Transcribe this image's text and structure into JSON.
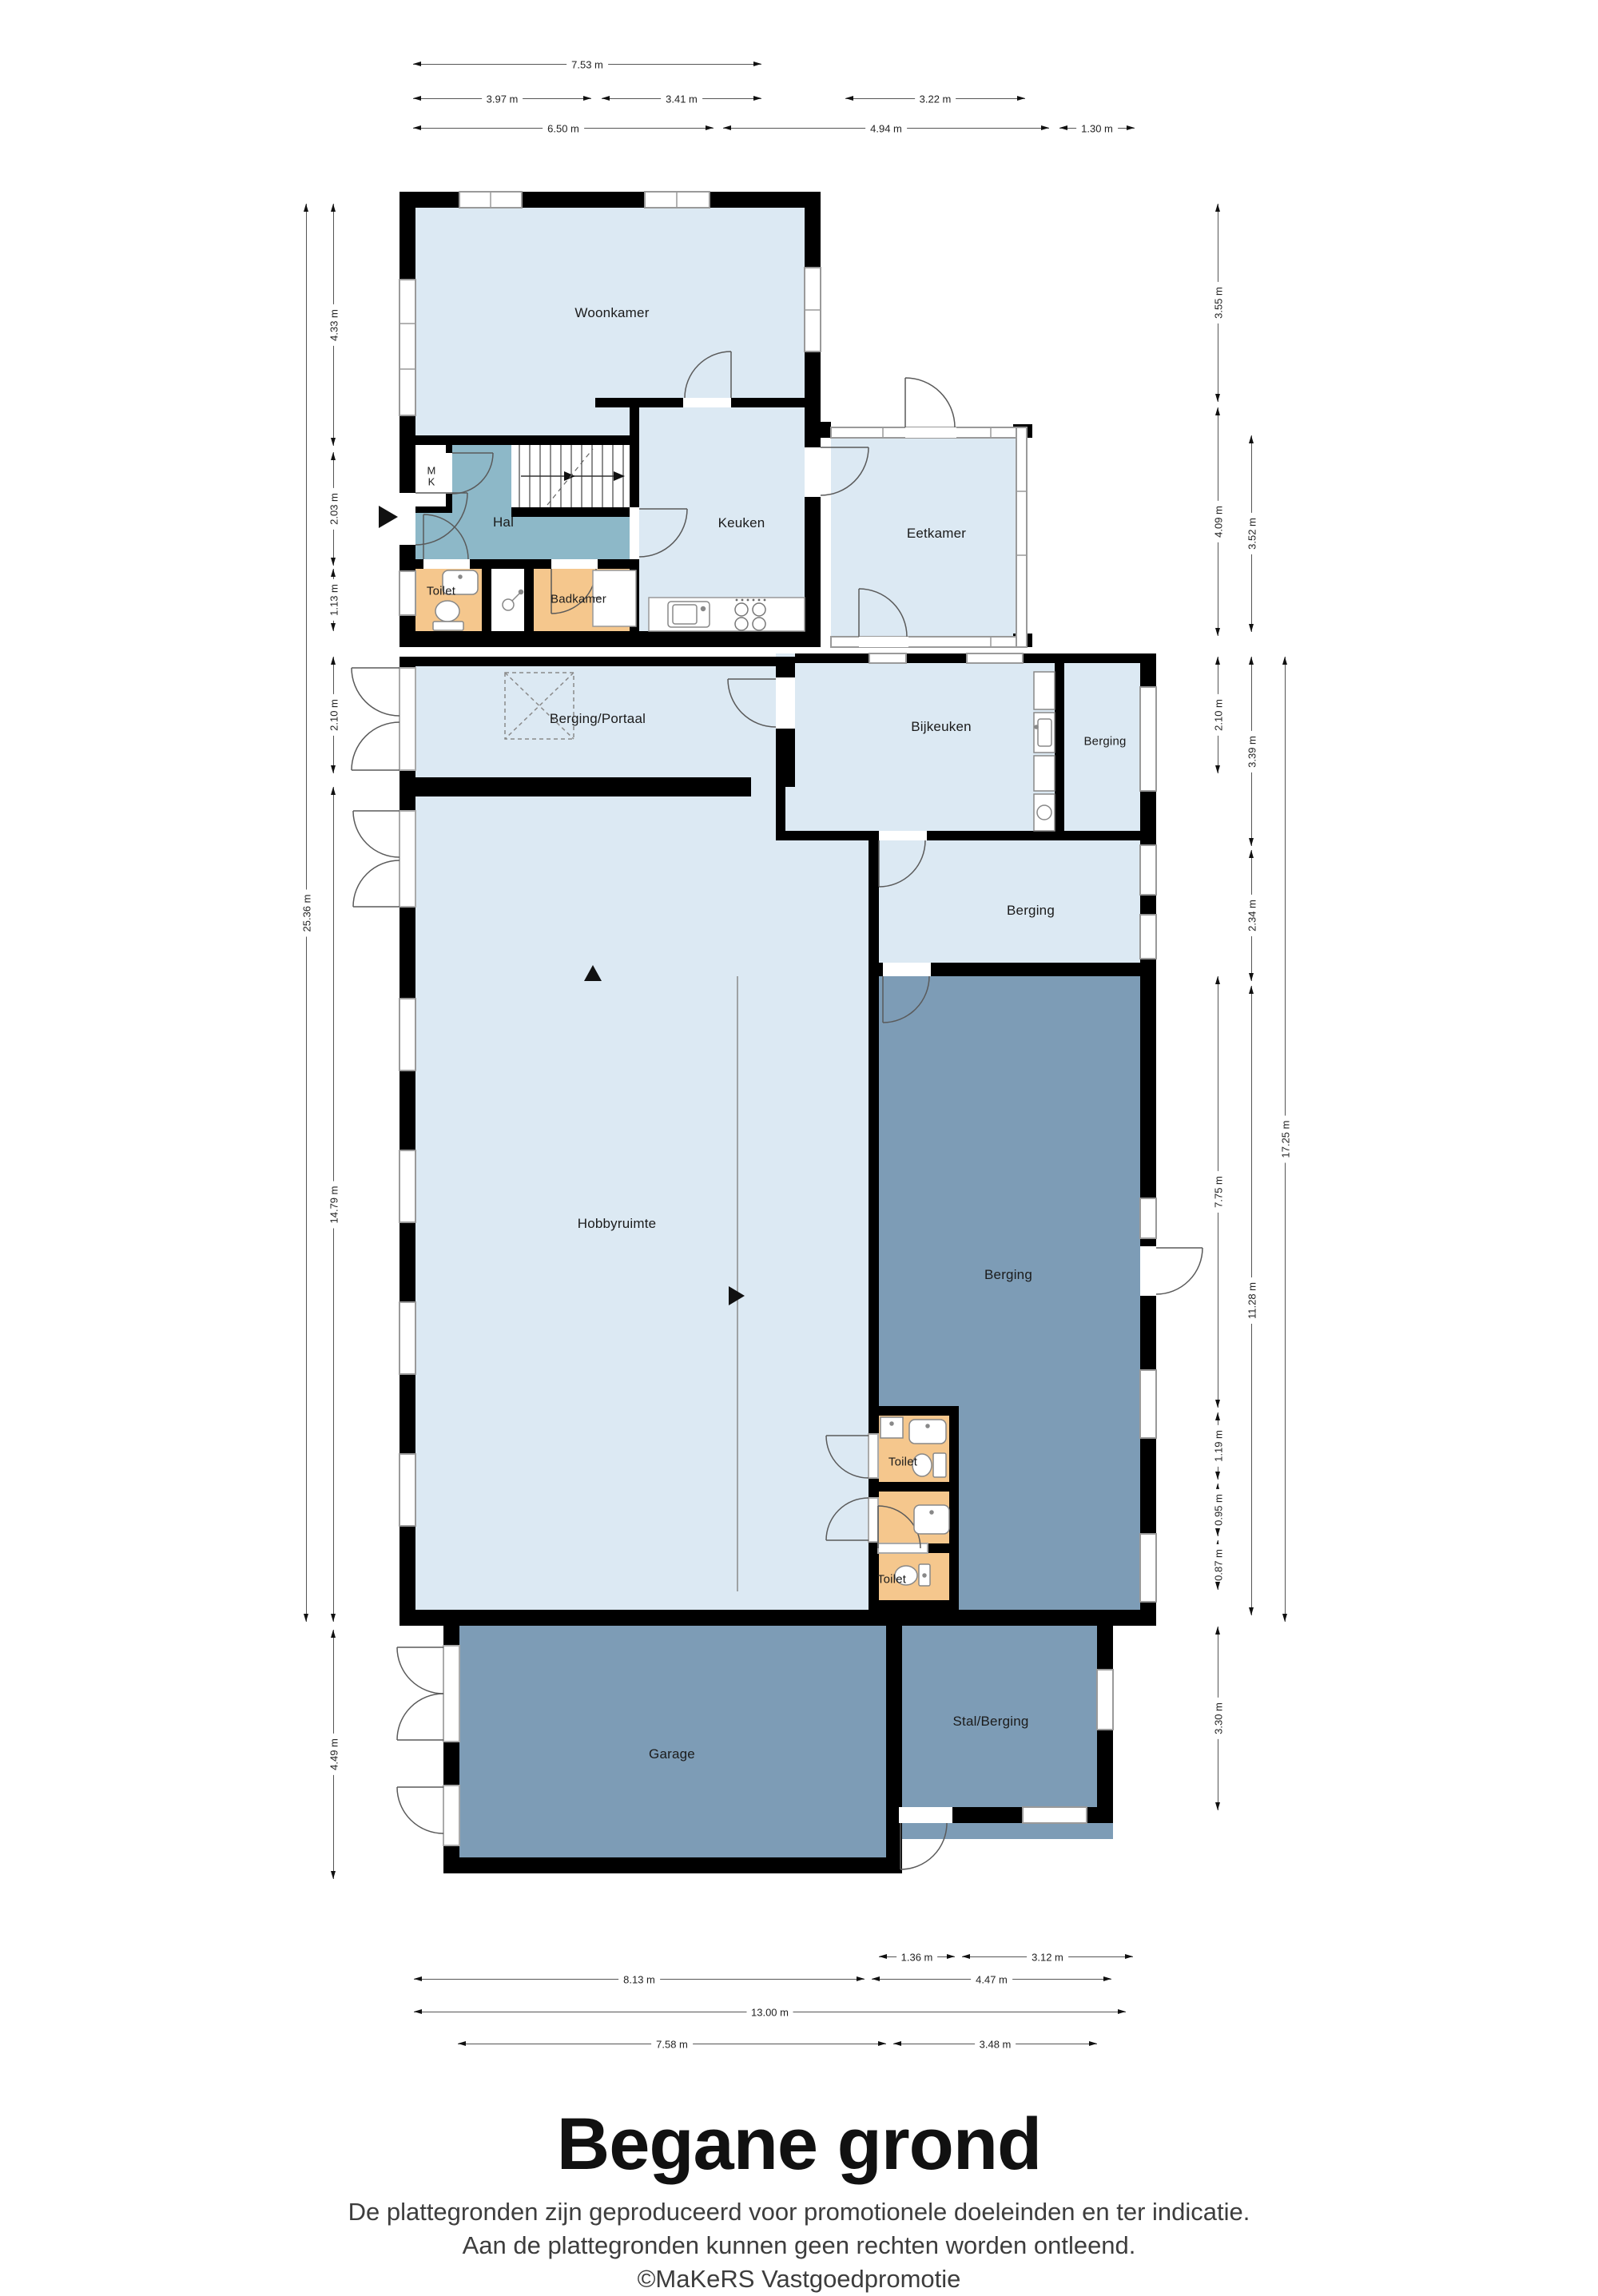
{
  "title": "Begane grond",
  "footer": {
    "line1": "De plattegronden zijn geproduceerd voor promotionele doeleinden en ter indicatie.",
    "line2": "Aan de plattegronden kunnen geen rechten worden ontleend.",
    "line3": "©MaKeRS Vastgoedpromotie"
  },
  "rooms": {
    "woonkamer": "Woonkamer",
    "hal": "Hal",
    "meterkast": "MK",
    "keuken": "Keuken",
    "eetkamer": "Eetkamer",
    "toilet_voor": "Toilet",
    "badkamer": "Badkamer",
    "berging_portaal": "Berging/Portaal",
    "bijkeuken": "Bijkeuken",
    "berging_klein": "Berging",
    "berging_midden": "Berging",
    "hobbyruimte": "Hobbyruimte",
    "berging_groot": "Berging",
    "toilet_achter_1": "Toilet",
    "toilet_achter_2": "Toilet",
    "garage": "Garage",
    "stal_berging": "Stal/Berging"
  },
  "dims": {
    "top": [
      "7.53 m",
      "3.97 m",
      "3.41 m",
      "3.22 m",
      "6.50 m",
      "4.94 m",
      "1.30 m"
    ],
    "left": [
      "25.36 m",
      "4.33 m",
      "2.03 m",
      "1.13 m",
      "2.10 m",
      "14.79 m",
      "4.49 m"
    ],
    "right": [
      "3.55 m",
      "4.09 m",
      "2.10 m",
      "7.75 m",
      "1.19 m",
      "0.95 m",
      "0.87 m",
      "3.30 m",
      "3.52 m",
      "3.39 m",
      "2.34 m",
      "11.28 m",
      "17.25 m"
    ],
    "bottom": [
      "1.36 m",
      "3.12 m",
      "8.13 m",
      "4.47 m",
      "13.00 m",
      "7.58 m",
      "3.48 m"
    ]
  },
  "colors": {
    "room_light_blue": "#dce9f3",
    "room_hal_teal": "#8db8c8",
    "room_sanitary_orange": "#f5c78d",
    "room_dark_blue": "#7d9cb6",
    "wall_black": "#000000",
    "window_frame_gray": "#9a9a9a"
  }
}
